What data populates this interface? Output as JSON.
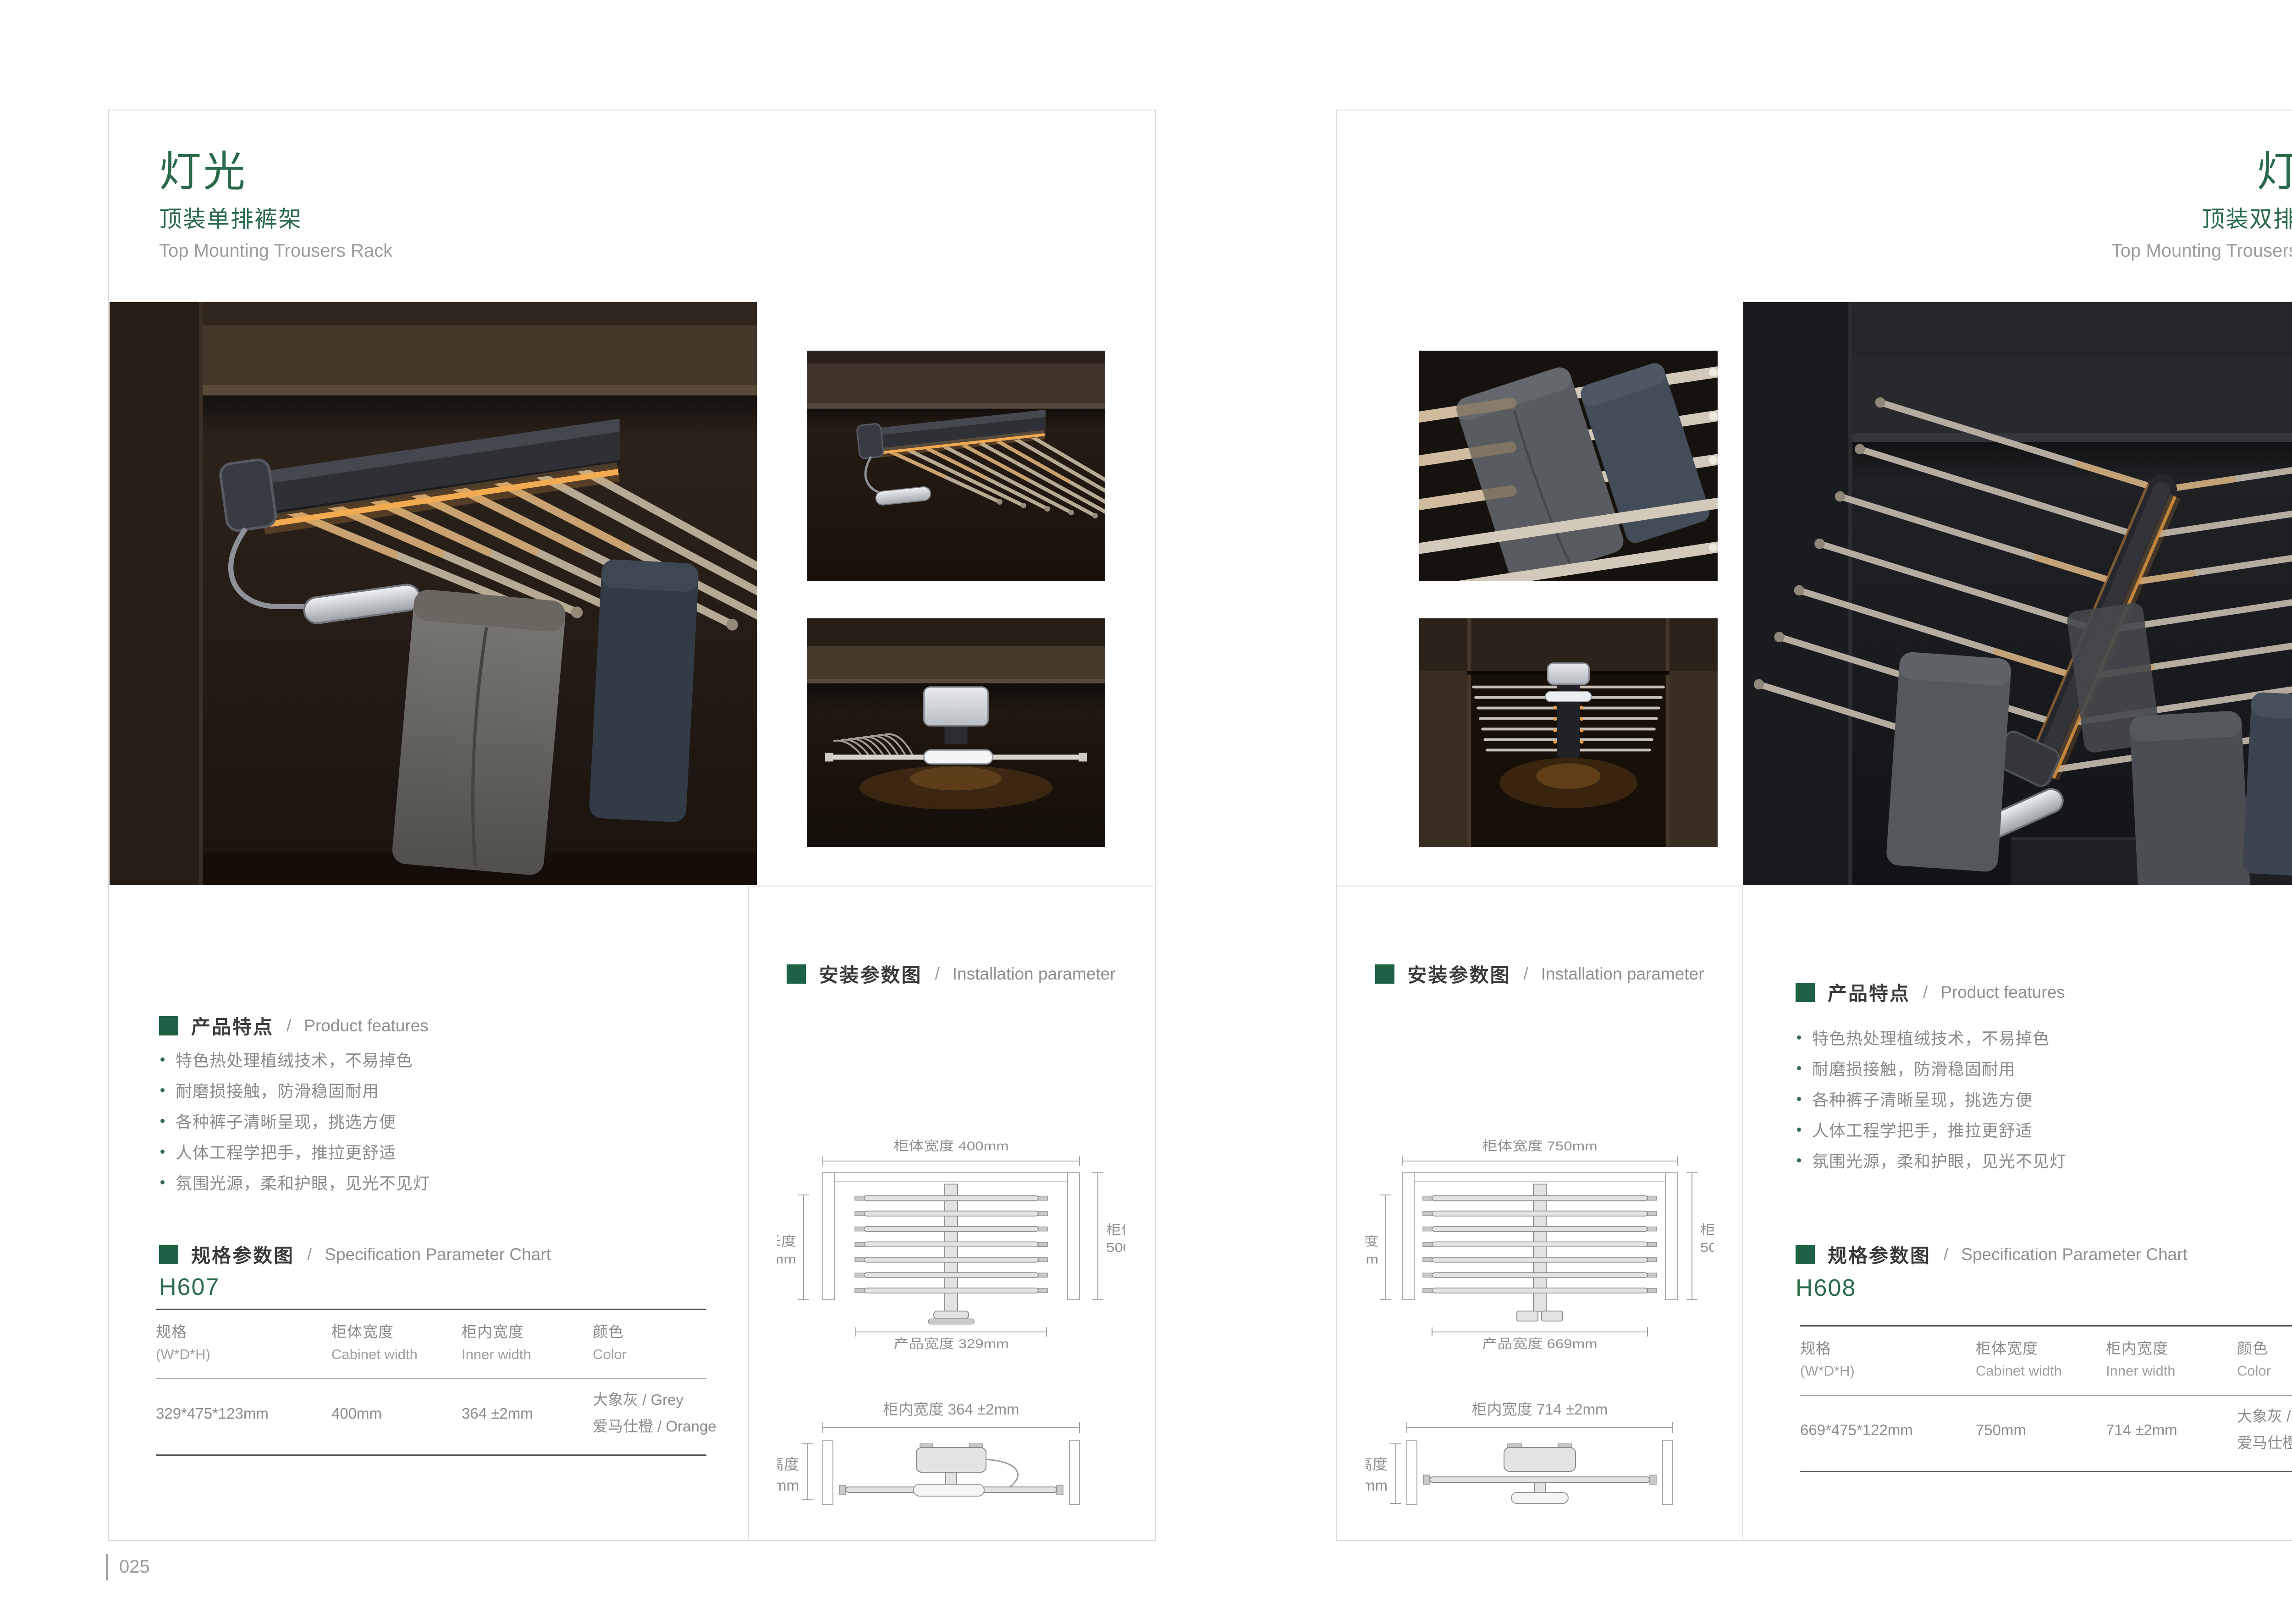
{
  "colors": {
    "accent_green": "#2a6a4b",
    "section_square_green": "#1d6244",
    "text_dark": "#3a3a3a",
    "text_gray": "#8a8a8a",
    "card_border": "#dcdcdc",
    "led_amber": "#e8a04a"
  },
  "left_page": {
    "title": "灯光",
    "subtitle_cn": "顶装单排裤架",
    "subtitle_en": "Top Mounting Trousers Rack",
    "page_number": "025",
    "features": {
      "cn": "产品特点",
      "sep": "/",
      "en": "Product features",
      "items": [
        "特色热处理植绒技术，不易掉色",
        "耐磨损接触，防滑稳固耐用",
        "各种裤子清晰呈现，挑选方便",
        "人体工程学把手，推拉更舒适",
        "氛围光源，柔和护眼，见光不见灯"
      ]
    },
    "spec": {
      "cn": "规格参数图",
      "sep": "/",
      "en": "Specification Parameter Chart",
      "model": "H607",
      "columns": [
        [
          "规格",
          "(W*D*H)"
        ],
        [
          "柜体宽度",
          "Cabinet width"
        ],
        [
          "柜内宽度",
          "Inner width"
        ],
        [
          "颜色",
          "Color"
        ]
      ],
      "row": [
        "329*475*123mm",
        "400mm",
        "364 ±2mm"
      ],
      "color_lines": [
        "大象灰  / Grey",
        "爱马仕橙 / Orange"
      ]
    },
    "install": {
      "cn": "安装参数图",
      "sep": "/",
      "en": "Installation parameter",
      "top_view": {
        "cabinet_width": "柜体宽度 400mm",
        "product_length": [
          "产品长度",
          "475mm"
        ],
        "cabinet_depth": [
          "柜体深度",
          "500mm"
        ],
        "product_width": "产品宽度 329mm"
      },
      "front_view": {
        "inner_width": "柜内宽度 364 ±2mm",
        "product_height": [
          "产品高度",
          "123mm"
        ]
      }
    }
  },
  "right_page": {
    "title": "灯光",
    "subtitle_cn": "顶装双排裤架",
    "subtitle_en": "Top Mounting Trousers Rack",
    "page_number": "026",
    "features": {
      "cn": "产品特点",
      "sep": "/",
      "en": "Product features",
      "items": [
        "特色热处理植绒技术，不易掉色",
        "耐磨损接触，防滑稳固耐用",
        "各种裤子清晰呈现，挑选方便",
        "人体工程学把手，推拉更舒适",
        "氛围光源，柔和护眼，见光不见灯"
      ]
    },
    "spec": {
      "cn": "规格参数图",
      "sep": "/",
      "en": "Specification Parameter Chart",
      "model": "H608",
      "columns": [
        [
          "规格",
          "(W*D*H)"
        ],
        [
          "柜体宽度",
          "Cabinet width"
        ],
        [
          "柜内宽度",
          "Inner width"
        ],
        [
          "颜色",
          "Color"
        ]
      ],
      "row": [
        "669*475*122mm",
        "750mm",
        "714 ±2mm"
      ],
      "color_lines": [
        "大象灰  / Grey",
        "爱马仕橙 / Orange"
      ]
    },
    "install": {
      "cn": "安装参数图",
      "sep": "/",
      "en": "Installation parameter",
      "top_view": {
        "cabinet_width": "柜体宽度 750mm",
        "product_length": [
          "产品长度",
          "475mm"
        ],
        "cabinet_depth": [
          "柜体深度",
          "500mm"
        ],
        "product_width": "产品宽度 669mm"
      },
      "front_view": {
        "inner_width": "柜内宽度 714 ±2mm",
        "product_height": [
          "产品高度",
          "122mm"
        ]
      }
    }
  }
}
